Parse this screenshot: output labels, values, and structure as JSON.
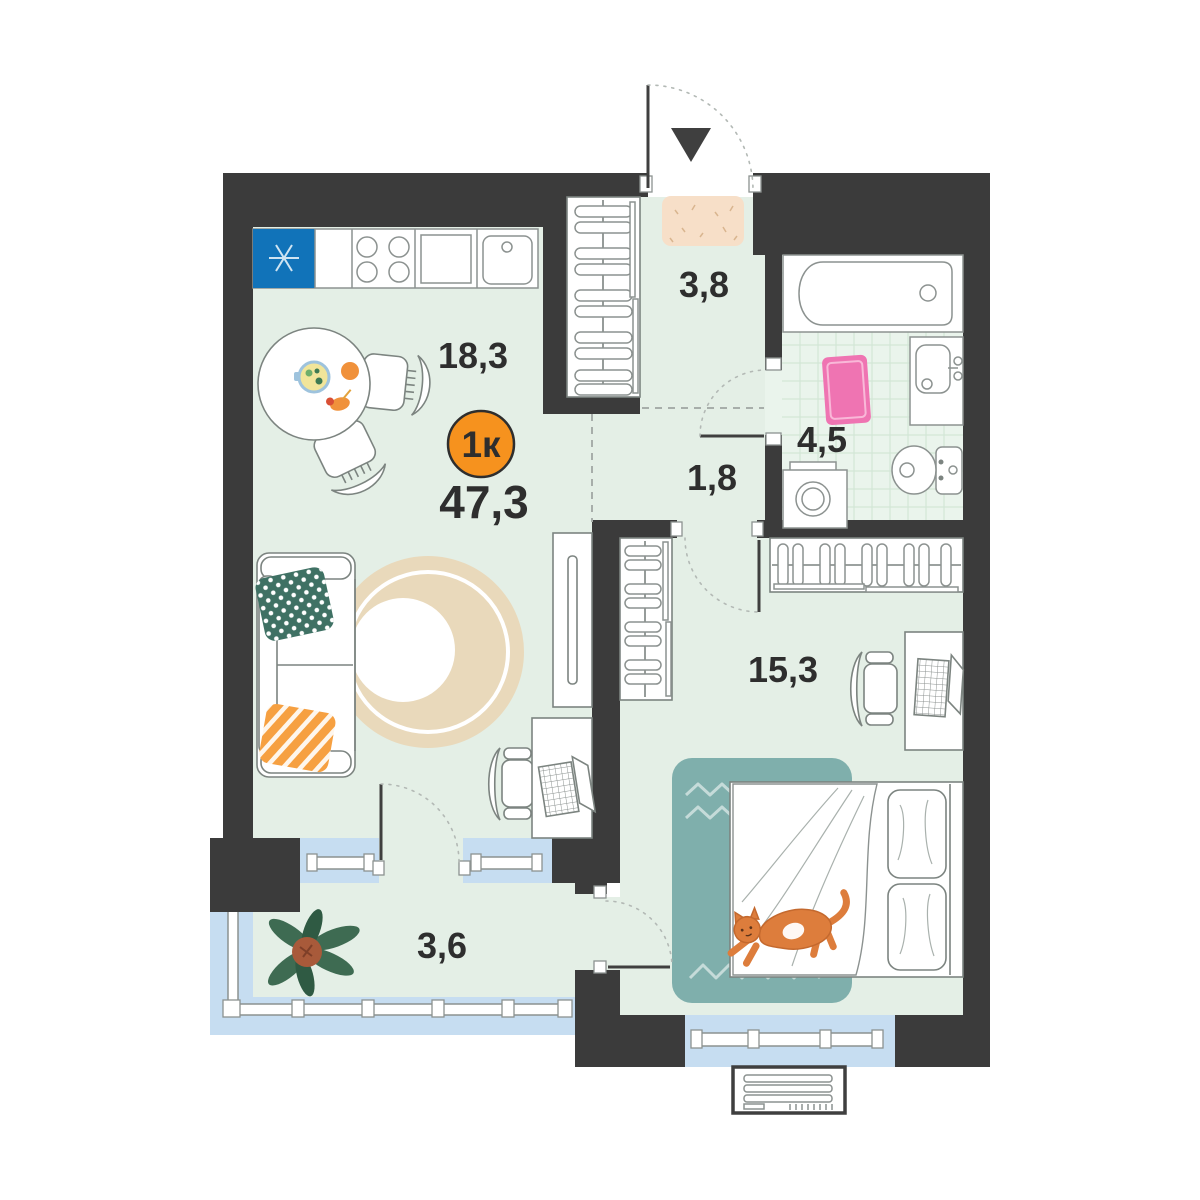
{
  "title": "1-room apartment floor plan",
  "badge": {
    "type_label": "1к",
    "total_area": "47,3"
  },
  "rooms": [
    {
      "name": "kitchen-living-room",
      "area_label": "18,3"
    },
    {
      "name": "entry-hall",
      "area_label": "3,8"
    },
    {
      "name": "bathroom",
      "area_label": "4,5"
    },
    {
      "name": "hallway",
      "area_label": "1,8"
    },
    {
      "name": "bedroom",
      "area_label": "15,3"
    },
    {
      "name": "balcony",
      "area_label": "3,6"
    }
  ],
  "colors": {
    "wall": "#3b3b3b",
    "floor": "#e4efe6",
    "bath_tile_line": "#d3e6d6",
    "window_glass": "#c6ddf1",
    "badge_orange": "#f6921e",
    "fridge_blue": "#1173b9",
    "bath_mat_pink": "#ef74b2",
    "bed_rug_teal": "#7fafac",
    "living_rug_beige": "#e9d9bb",
    "doormat_beige": "#f7dfc8",
    "pillow_green": "#3f7164",
    "pillow_orange": "#f6a041",
    "cat_orange": "#dd7d3c",
    "plant_green": "#3e6b52",
    "plant_pot": "#a85a3a"
  }
}
